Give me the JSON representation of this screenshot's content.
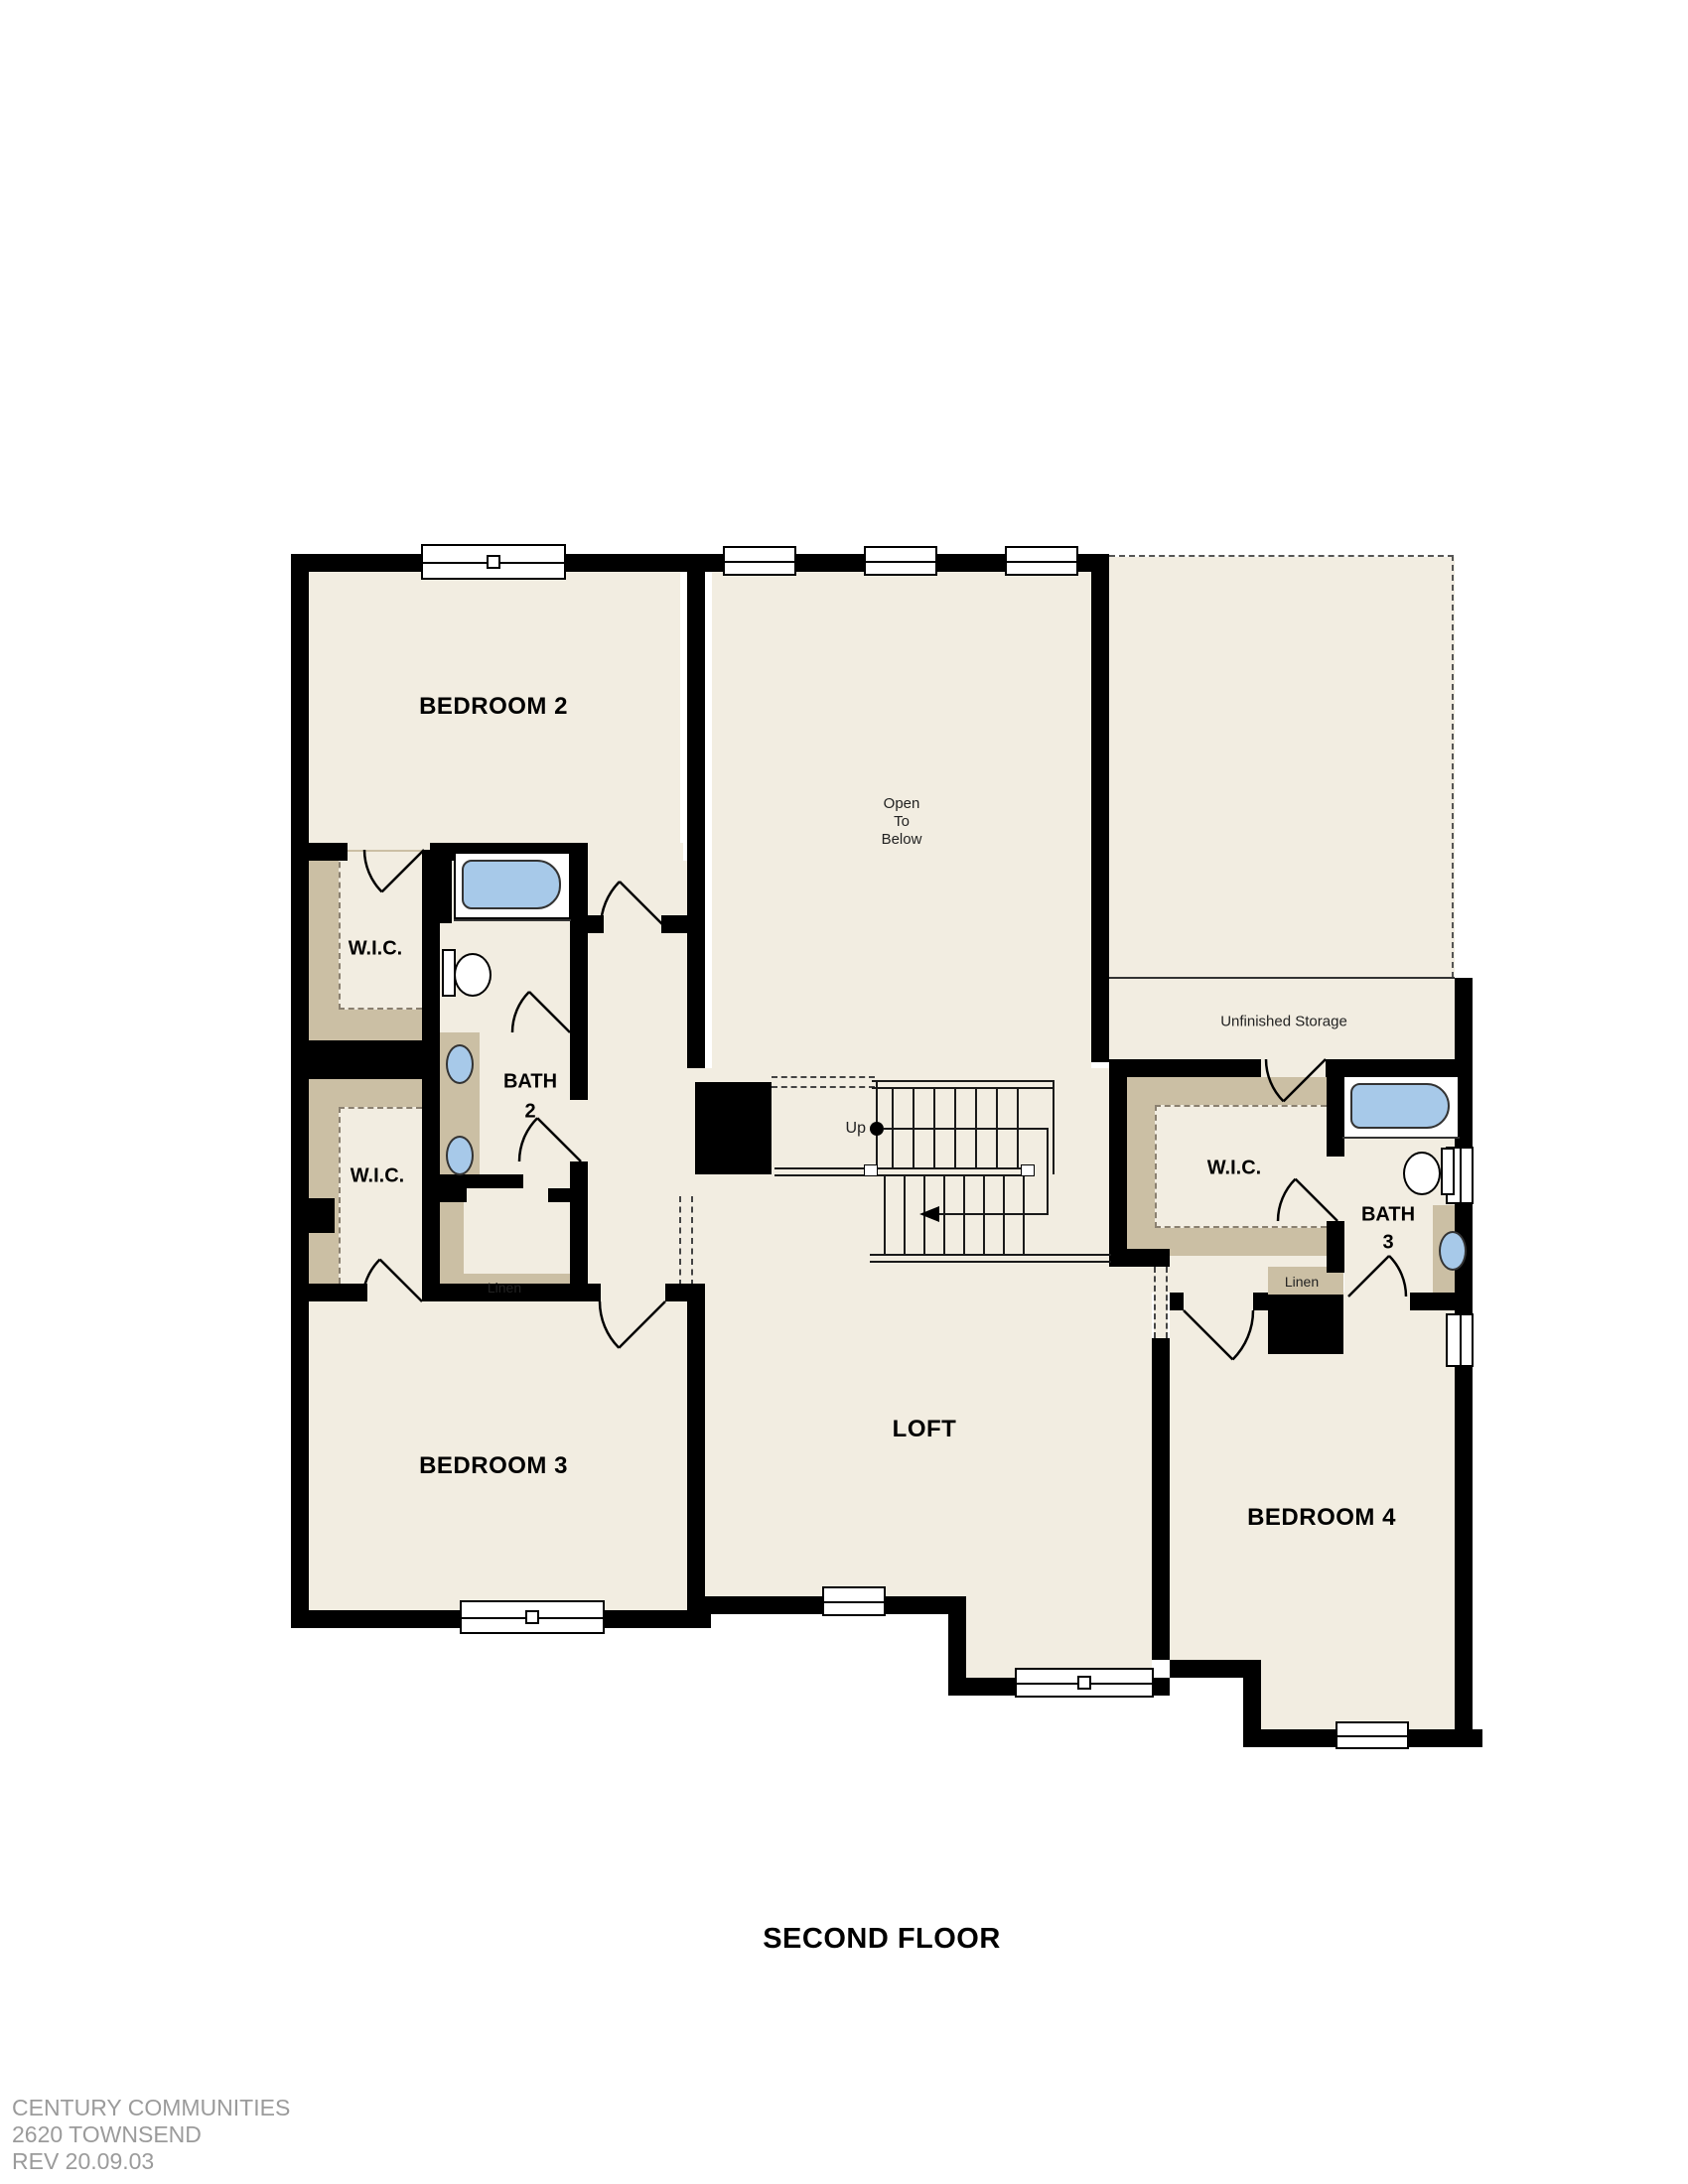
{
  "page": {
    "title": "SECOND FLOOR"
  },
  "footer": {
    "company": "CENTURY COMMUNITIES",
    "plan": "2620 TOWNSEND",
    "revision": "REV 20.09.03"
  },
  "labels": {
    "bedroom2": "BEDROOM 2",
    "bedroom3": "BEDROOM 3",
    "bedroom4": "BEDROOM 4",
    "loft": "LOFT",
    "wic": "W.I.C.",
    "bath2_name": "BATH",
    "bath2_number": "2",
    "bath3_name": "BATH",
    "bath3_number": "3",
    "linen": "Linen",
    "unfinished_storage": "Unfinished Storage",
    "open_line1": "Open",
    "open_line2": "To",
    "open_line3": "Below",
    "up": "Up"
  },
  "colors": {
    "floor": "#f2ede1",
    "closet": "#cbbfa4",
    "wall": "#000000",
    "line": "#1a1a1a",
    "fixture_fill": "#a7c9e9",
    "fixture_stroke": "#333333",
    "footer_text": "#9b9b9b"
  }
}
